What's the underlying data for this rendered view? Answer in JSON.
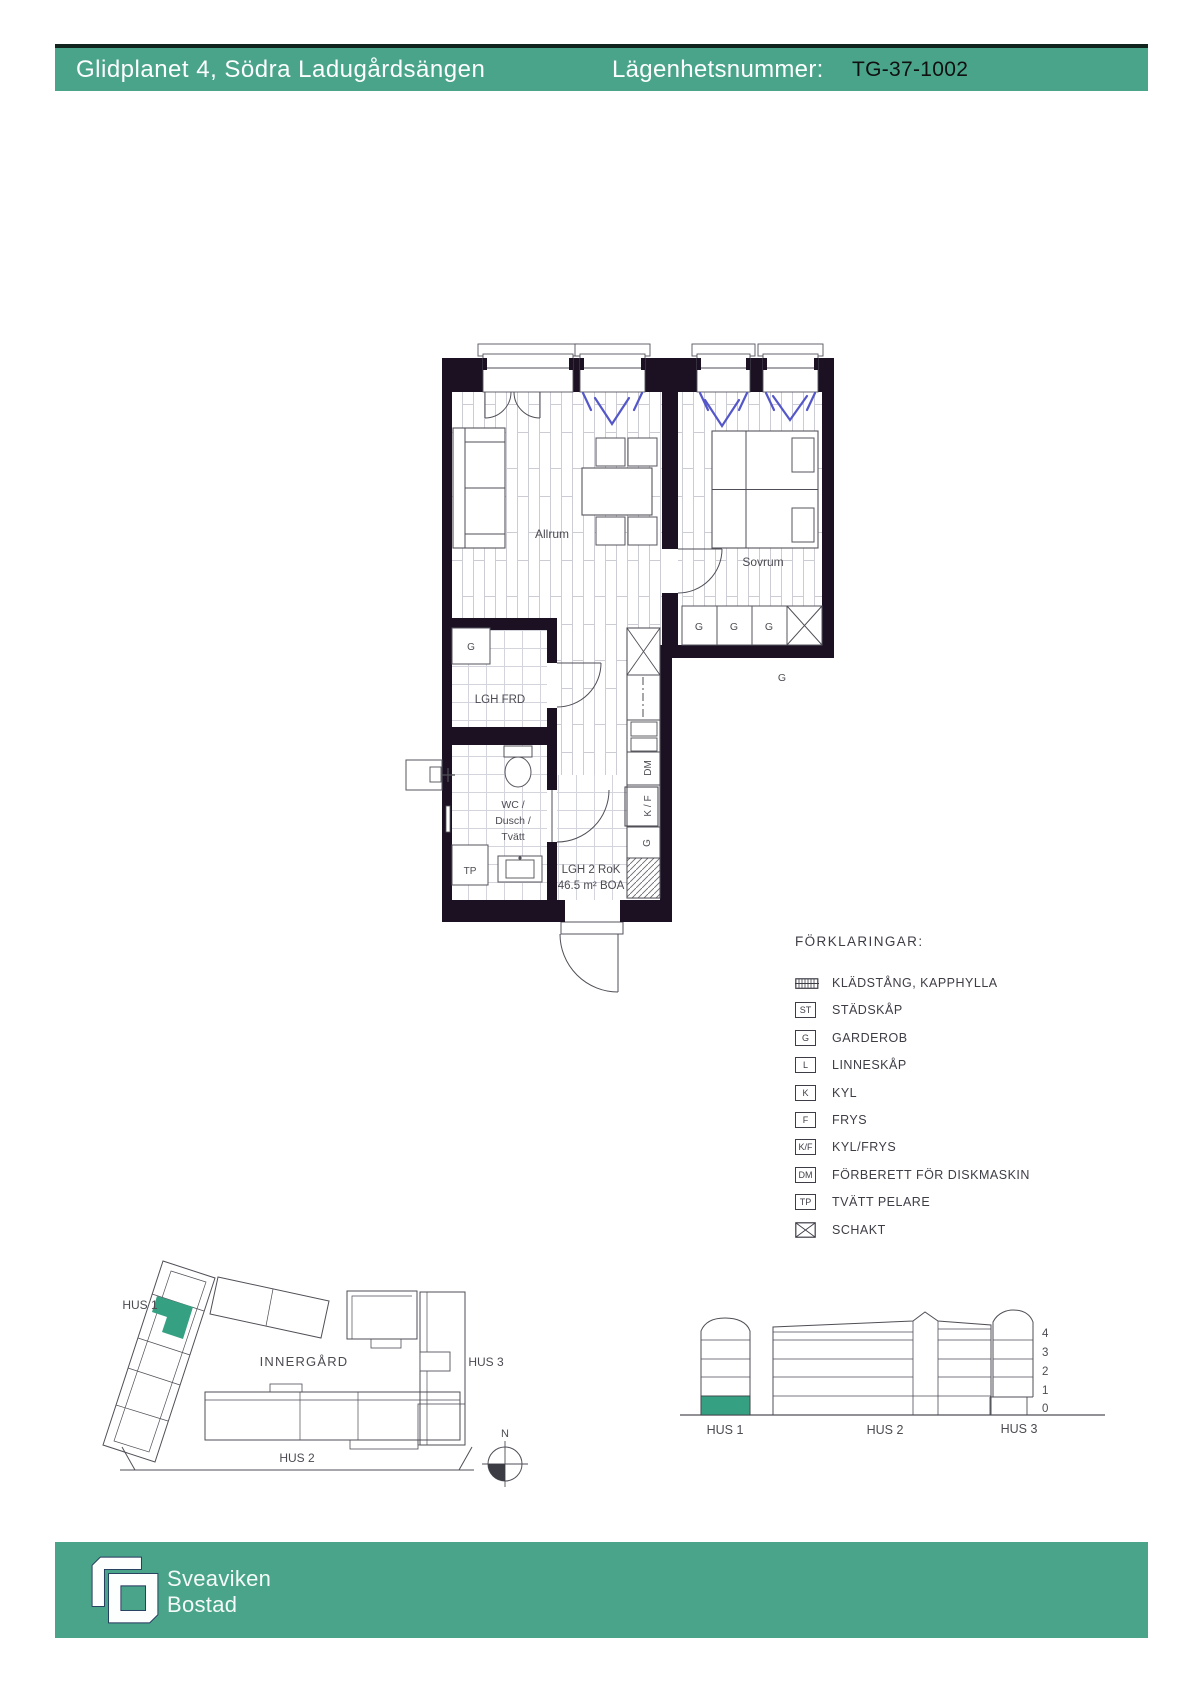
{
  "header": {
    "project_title": "Glidplanet 4, Södra Ladugårdsängen",
    "apartment_label": "Lägenhetsnummer:",
    "apartment_number": "TG-37-1002"
  },
  "floor_plan": {
    "rooms": {
      "living": "Allrum",
      "bedroom": "Sovrum",
      "storage": "LGH FRD",
      "bath_line1": "WC /",
      "bath_line2": "Dusch /",
      "bath_line3": "Tvätt"
    },
    "area": {
      "line1": "LGH 2 RoK",
      "line2": "46.5 m² BOA"
    },
    "fixtures": {
      "wardrobe": "G",
      "laundry_tower": "TP",
      "dishwasher": "DM",
      "fridge_freezer": "K / F"
    }
  },
  "legend": {
    "title": "FÖRKLARINGAR:",
    "items": [
      {
        "symbol": "",
        "symbol_type": "hatch-box",
        "label": "KLÄDSTÅNG, KAPPHYLLA"
      },
      {
        "symbol": "ST",
        "symbol_type": "letter-box",
        "label": "STÄDSKÅP"
      },
      {
        "symbol": "G",
        "symbol_type": "letter-box",
        "label": "GARDEROB"
      },
      {
        "symbol": "L",
        "symbol_type": "letter-box",
        "label": "LINNESKÅP"
      },
      {
        "symbol": "K",
        "symbol_type": "letter-box",
        "label": "KYL"
      },
      {
        "symbol": "F",
        "symbol_type": "letter-box",
        "label": "FRYS"
      },
      {
        "symbol": "K/F",
        "symbol_type": "letter-box",
        "label": "KYL/FRYS"
      },
      {
        "symbol": "DM",
        "symbol_type": "letter-box",
        "label": "FÖRBERETT FÖR DISKMASKIN"
      },
      {
        "symbol": "TP",
        "symbol_type": "letter-box",
        "label": "TVÄTT PELARE"
      },
      {
        "symbol": "",
        "symbol_type": "crossed-box",
        "label": "SCHAKT"
      }
    ]
  },
  "site_plan": {
    "hus1": "HUS 1",
    "hus2": "HUS 2",
    "hus3": "HUS 3",
    "courtyard": "INNERGÅRD",
    "north": "N"
  },
  "elevation": {
    "floors": [
      "4",
      "3",
      "2",
      "1",
      "0"
    ],
    "hus1": "HUS 1",
    "hus2": "HUS 2",
    "hus3": "HUS 3"
  },
  "footer": {
    "brand_line1": "Sveaviken",
    "brand_line2": "Bostad"
  },
  "colors": {
    "brand_green": "#4aa48a",
    "unit_green": "#36a083",
    "wall_dark": "#1b1123",
    "vent_blue": "#5457c9"
  }
}
